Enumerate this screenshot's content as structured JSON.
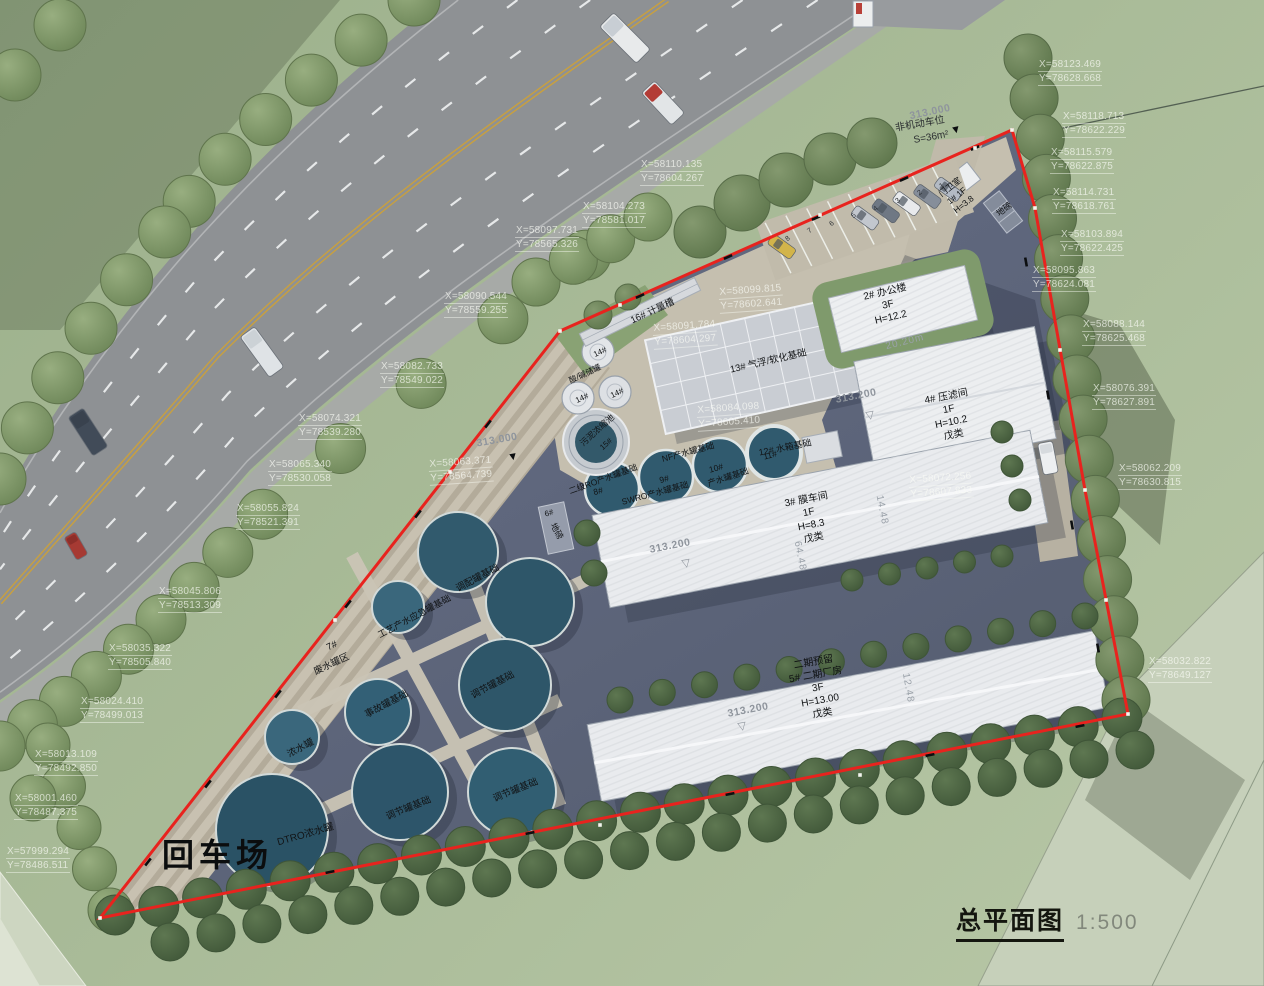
{
  "title": {
    "name": "总平面图",
    "scale": "1:500"
  },
  "big_labels": {
    "turnaround": "回车场"
  },
  "annotations": {
    "bike_parking": [
      "非机动车位",
      "S=36m²"
    ],
    "elevations": [
      "313.000",
      "313.000",
      "313.200",
      "313.200",
      "313.200"
    ],
    "dimensions": [
      "20.20m",
      "64.48",
      "14.48",
      "12.48"
    ],
    "stall_numbers": [
      "8",
      "7",
      "6",
      "5",
      "4",
      "3",
      "2",
      "1"
    ]
  },
  "buildings": [
    {
      "lines": [
        "门卫室",
        "1# 1F",
        "H=3.8"
      ]
    },
    {
      "lines": [
        "2#  办公楼",
        "3F",
        "H=12.2"
      ]
    },
    {
      "lines": [
        "4#  压滤间",
        "1F",
        "H=10.2",
        "戊类"
      ]
    },
    {
      "lines": [
        "3#  膜车间",
        "1F",
        "H=8.3",
        "戊类"
      ]
    },
    {
      "lines": [
        "二期预留",
        "5#  二期厂房",
        "3F",
        "H=13.00",
        "戊类"
      ]
    }
  ],
  "facilities": [
    {
      "text": "16#  计量槽"
    },
    {
      "text": "13#  气浮/软化基础"
    },
    {
      "text": "14#"
    },
    {
      "text": "14#"
    },
    {
      "text": "14#"
    },
    {
      "text": "酸/碱储罐"
    },
    {
      "text": "污泥浓缩池"
    },
    {
      "text": "15#"
    },
    {
      "text": "8#"
    },
    {
      "text": "二级RO产水罐基础"
    },
    {
      "text": "9#"
    },
    {
      "text": "SWRO产水罐基础"
    },
    {
      "text": "10#"
    },
    {
      "text": "NF产水罐基础"
    },
    {
      "text": "11#"
    },
    {
      "text": "产水罐基础"
    },
    {
      "text": "12#  水箱基础"
    },
    {
      "text": "6#"
    },
    {
      "text": "地磅"
    },
    {
      "text": "地磅"
    },
    {
      "text": "调配罐基础"
    },
    {
      "text": "工艺产水应急罐基础"
    },
    {
      "text": "7#"
    },
    {
      "text": "废水罐区"
    },
    {
      "text": "事故罐基础"
    },
    {
      "text": "调节罐基础"
    },
    {
      "text": "浓水罐"
    },
    {
      "text": "调节罐基础"
    },
    {
      "text": "调节罐基础"
    },
    {
      "text": "DTRO浓水罐"
    }
  ],
  "coords": [
    {
      "x": "X=58123.469",
      "y": "Y=78628.668"
    },
    {
      "x": "X=58118.713",
      "y": "Y=78622.229"
    },
    {
      "x": "X=58115.579",
      "y": "Y=78622.875"
    },
    {
      "x": "X=58114.731",
      "y": "Y=78618.761"
    },
    {
      "x": "X=58103.894",
      "y": "Y=78622.425"
    },
    {
      "x": "X=58095.863",
      "y": "Y=78624.081"
    },
    {
      "x": "X=58088.144",
      "y": "Y=78625.468"
    },
    {
      "x": "X=58076.391",
      "y": "Y=78627.891"
    },
    {
      "x": "X=58062.209",
      "y": "Y=78630.815"
    },
    {
      "x": "X=58032.822",
      "y": "Y=78649.127"
    },
    {
      "x": "X=58110.135",
      "y": "Y=78604.267"
    },
    {
      "x": "X=58104.273",
      "y": "Y=78581.017"
    },
    {
      "x": "X=58097.731",
      "y": "Y=78565.326"
    },
    {
      "x": "X=58090.544",
      "y": "Y=78559.255"
    },
    {
      "x": "X=58082.733",
      "y": "Y=78549.022"
    },
    {
      "x": "X=58074.321",
      "y": "Y=78539.280"
    },
    {
      "x": "X=58065.340",
      "y": "Y=78530.058"
    },
    {
      "x": "X=58055.824",
      "y": "Y=78521.391"
    },
    {
      "x": "X=58045.806",
      "y": "Y=78513.309"
    },
    {
      "x": "X=58035.322",
      "y": "Y=78505.840"
    },
    {
      "x": "X=58024.410",
      "y": "Y=78499.013"
    },
    {
      "x": "X=58013.109",
      "y": "Y=78492.850"
    },
    {
      "x": "X=58001.460",
      "y": "Y=78487.375"
    },
    {
      "x": "X=57999.294",
      "y": "Y=78486.511"
    },
    {
      "x": "X=58099.815",
      "y": "Y=78602.641"
    },
    {
      "x": "X=58091.784",
      "y": "Y=78604.297"
    },
    {
      "x": "X=58084.098",
      "y": "Y=78605.410"
    },
    {
      "x": "X=58072.256",
      "y": "Y=78607.833"
    },
    {
      "x": "X=58063.371",
      "y": "Y=78564.739"
    }
  ]
}
